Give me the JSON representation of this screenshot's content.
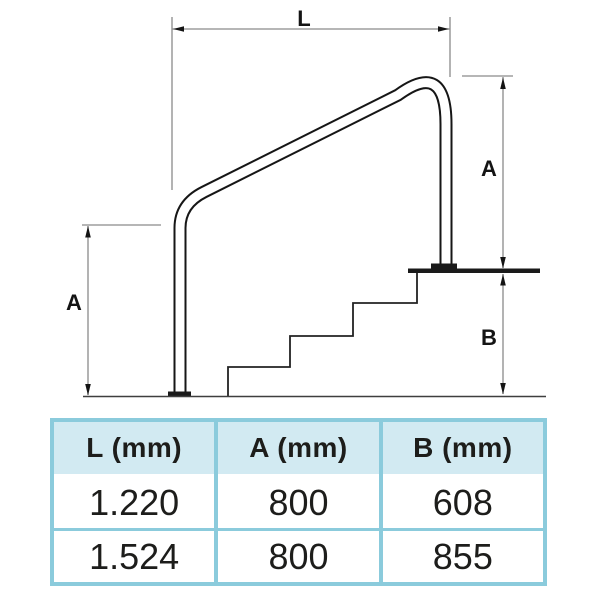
{
  "diagram": {
    "labels": {
      "length_top": "L",
      "height_left": "A",
      "height_right": "A",
      "depth_right": "B"
    }
  },
  "table": {
    "headers": [
      "L (mm)",
      "A (mm)",
      "B (mm)"
    ],
    "rows": [
      [
        "1.220",
        "800",
        "608"
      ],
      [
        "1.524",
        "800",
        "855"
      ]
    ]
  },
  "colors": {
    "table_border": "#8bcbdc",
    "table_header_bg": "#d2eaf2",
    "drawing_line": "#1a1a1a",
    "dimension_line": "#8a8a8a",
    "text": "#1d1d1b"
  }
}
